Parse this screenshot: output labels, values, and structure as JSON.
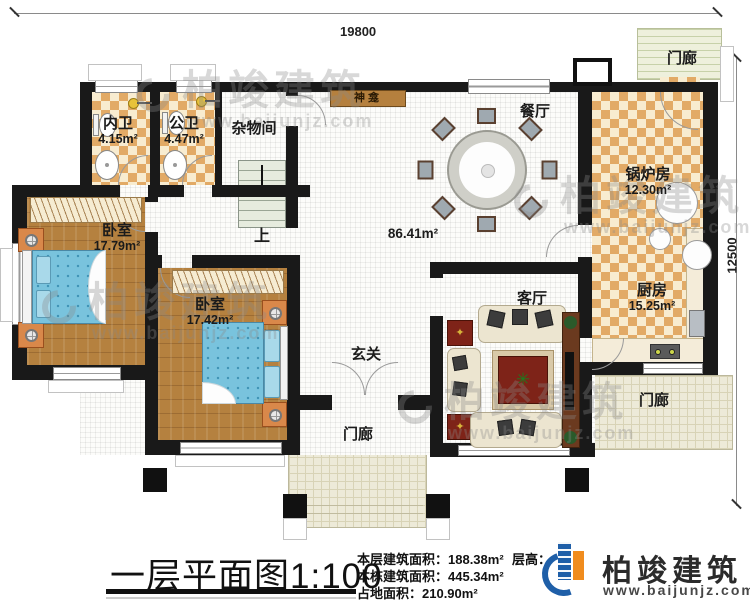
{
  "dimensions": {
    "top": "19800",
    "right": "12500"
  },
  "rooms": {
    "bath_ensuite": {
      "name": "内卫",
      "area": "4.15m²"
    },
    "bath_public": {
      "name": "公卫",
      "area": "4.47m²"
    },
    "storage": {
      "name": "杂物间"
    },
    "bedroom1": {
      "name": "卧室",
      "area": "17.79m²"
    },
    "bedroom2": {
      "name": "卧室",
      "area": "17.42m²"
    },
    "dining": {
      "name": "餐厅"
    },
    "boiler": {
      "name": "锅炉房",
      "area": "12.30m²"
    },
    "kitchen": {
      "name": "厨房",
      "area": "15.25m²"
    },
    "living": {
      "name": "客厅"
    },
    "foyer": {
      "name": "玄关"
    },
    "hall": {
      "area": "86.41m²"
    },
    "stairs": {
      "label": "上"
    },
    "shrine": {
      "label": "神龛"
    },
    "porch_top": {
      "name": "门廊"
    },
    "porch_right": {
      "name": "门廊"
    },
    "porch_bottom": {
      "name": "门廊"
    }
  },
  "watermark": {
    "brand": "柏竣建筑",
    "url": "www.baijunjz.com"
  },
  "footer": {
    "title": "一层平面图1:100",
    "stat1": "本层建筑面积：188.38m²",
    "stat2": "本栋建筑面积：445.34m²",
    "stat3": "占地面积：210.90m²",
    "floor_height_label": "层高：",
    "brand": "柏竣建筑",
    "brand_url": "www.baijunjz.com"
  },
  "colors": {
    "wall": "#191919",
    "checker_tan": "#e2aa66",
    "wood": "#b5813f",
    "bed_blue": "#79c3dd",
    "brand_blue": "#1f5fa8",
    "brand_orange": "#f08c1e"
  }
}
